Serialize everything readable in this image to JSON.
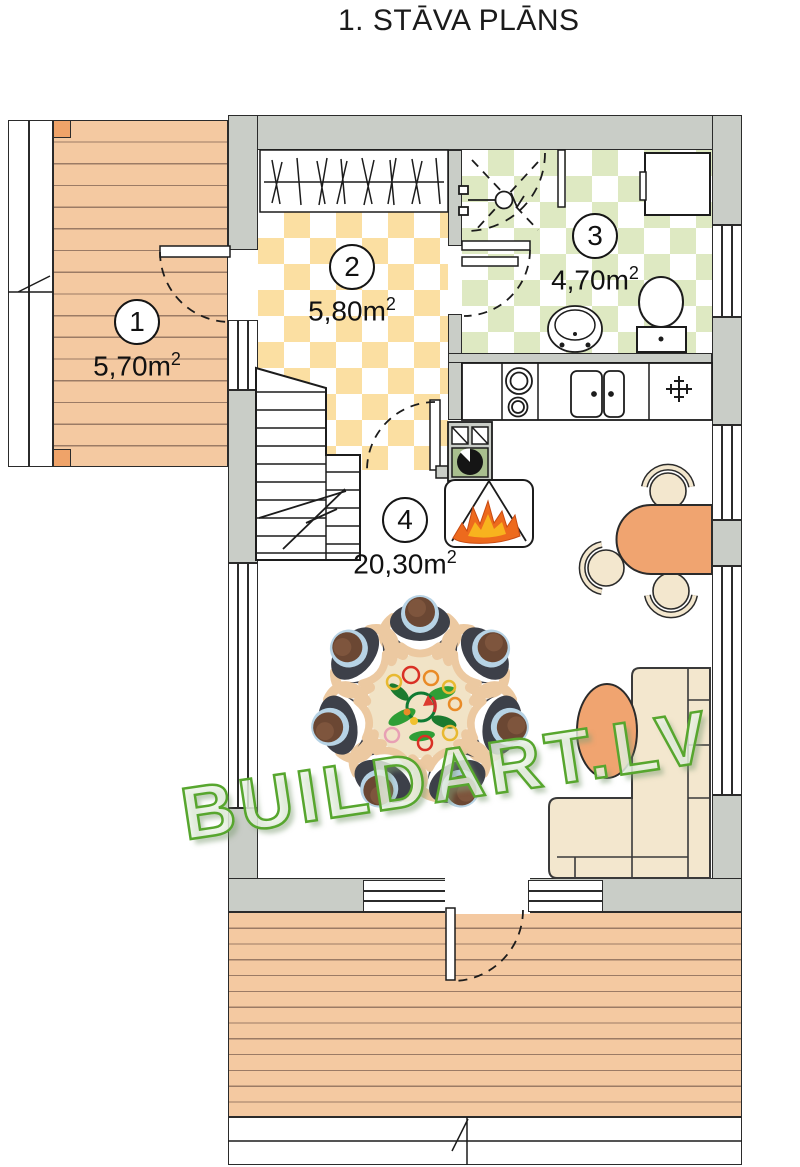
{
  "title": "1. STĀVA PLĀNS",
  "watermark": "BUILDART.LV",
  "rooms": [
    {
      "number": "1",
      "area": "5,70m",
      "area_sup": "2"
    },
    {
      "number": "2",
      "area": "5,80m",
      "area_sup": "2"
    },
    {
      "number": "3",
      "area": "4,70m",
      "area_sup": "2"
    },
    {
      "number": "4",
      "area": "20,30m",
      "area_sup": "2"
    }
  ],
  "colors": {
    "wall_gray": "#c9cdc7",
    "deck_wood": "#f4c9a1",
    "deck_plank_line": "#9b7b65",
    "hall_tile_yellow": "#fbdfa2",
    "bath_tile_green": "#dee9c2",
    "furniture_orange": "#f0a470",
    "furniture_cream": "#f3e7ce",
    "flame_orange": "#ed6a1d",
    "flame_yellow": "#f8b31e",
    "watermark_green": "#57a62e"
  }
}
